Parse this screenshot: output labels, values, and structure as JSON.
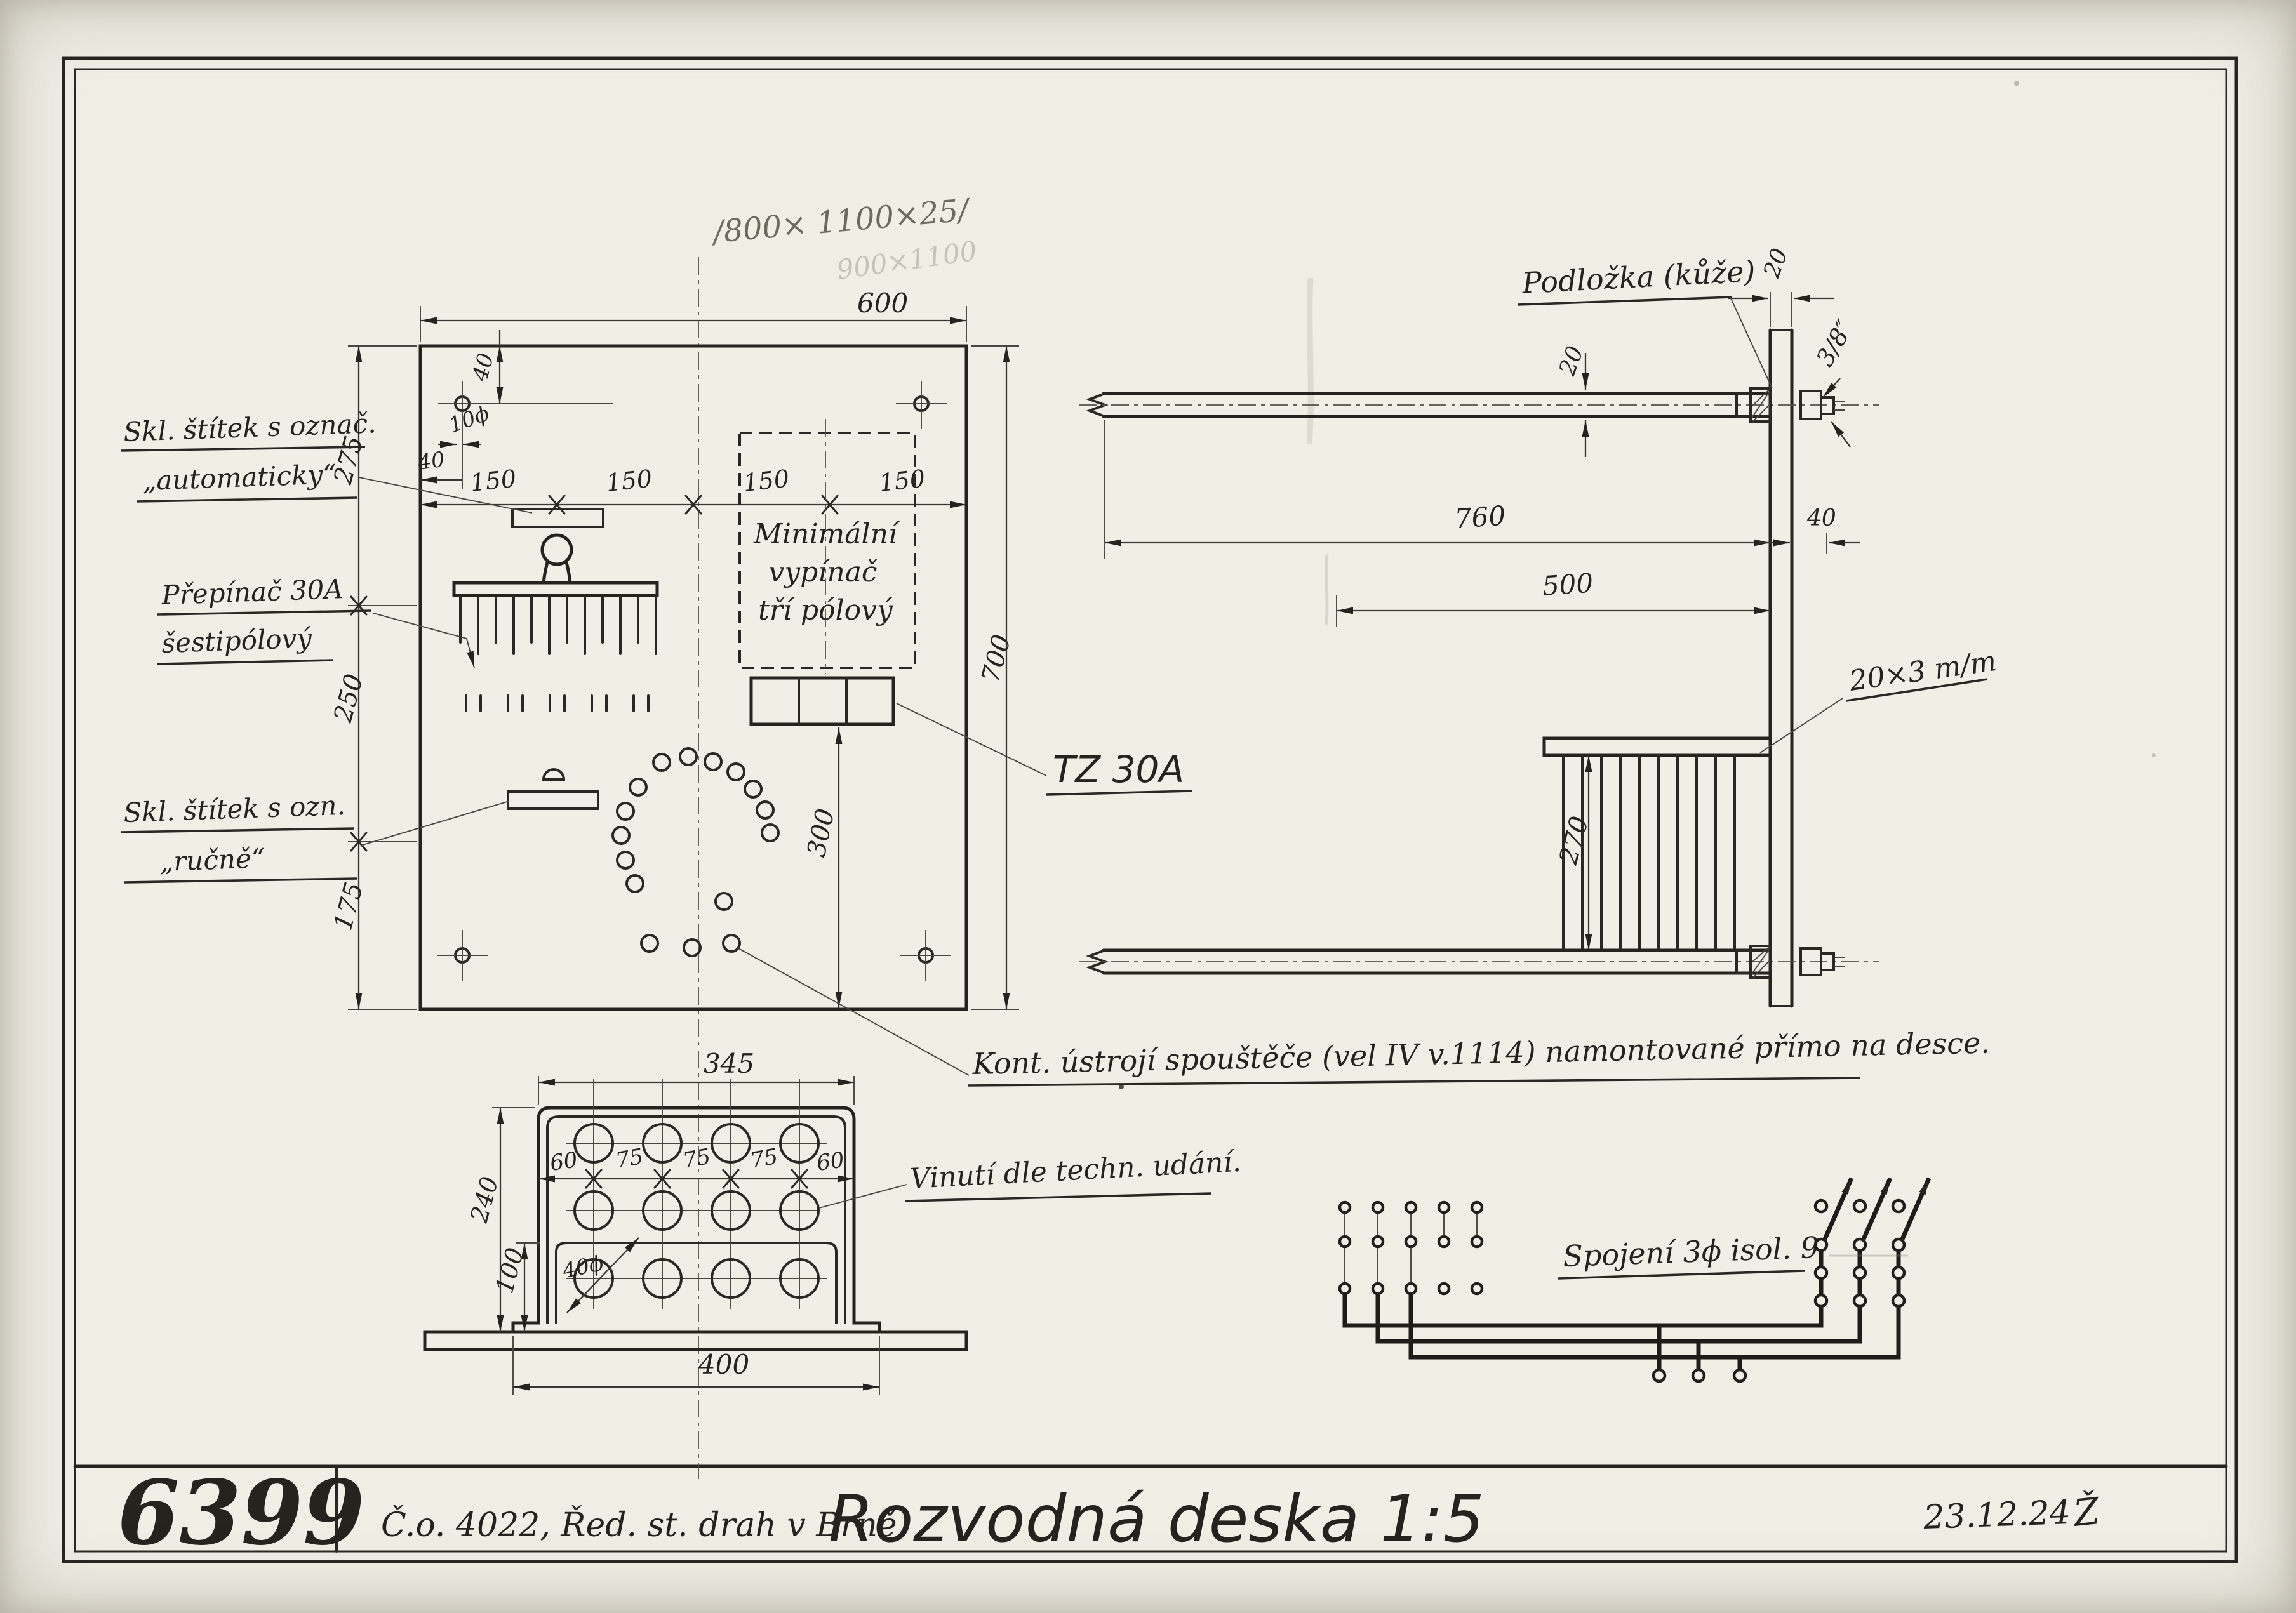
{
  "colors": {
    "paper": "#f1eee6",
    "ink": "#26231f",
    "pencil": "#8a8377"
  },
  "title_block": {
    "number": "6399",
    "reference": "Č.o. 4022, Řed. st. drah v Brně.",
    "title": "Rozvodná deska 1:5",
    "date": "23.12.24",
    "signature": "Ž"
  },
  "notes": {
    "pencil_dims": "/800× 1100×25/",
    "pencil_faint": "900×1100"
  },
  "labels": {
    "stitek_auto_line1": "Skl. štítek s označ.",
    "stitek_auto_line2": "„automaticky“",
    "prepinac_line1": "Přepínač 30A",
    "prepinac_line2": "šestipólový",
    "stitek_rucne_line1": "Skl. štítek s ozn.",
    "stitek_rucne_line2": "„ručně“",
    "min_vypinac_line1": "Minimální",
    "min_vypinac_line2": "vypínač",
    "min_vypinac_line3": "tří pólový",
    "tz": "TZ 30A",
    "podlozka": "Podložka (kůže)",
    "pasovina": "20×3 m/m",
    "kont": "Kont. ústrojí spouštěče (vel IV v.1114) namontované přímo na desce.",
    "vinuti": "Vinutí dle techn. udání.",
    "spojeni": "Spojení 3ϕ isol. 9"
  },
  "dims": {
    "front": {
      "width": "600",
      "height": "700",
      "spacing": [
        "150",
        "150",
        "150",
        "150"
      ],
      "left": [
        "275",
        "250",
        "175"
      ],
      "hole_dia": "10ϕ",
      "hole_top": "40",
      "hole_side": "40",
      "lower": "300"
    },
    "side": {
      "plate_th": "20",
      "bar_th": "20",
      "bolt": "3/8″",
      "len_total": "760",
      "len_grid": "500",
      "grid_h": "270",
      "offset": "40"
    },
    "box": {
      "width": "345",
      "height": "240",
      "lower": "100",
      "base": "400",
      "hole_dia": "40ϕ",
      "spacing": [
        "60",
        "75",
        "75",
        "75",
        "60"
      ]
    }
  }
}
